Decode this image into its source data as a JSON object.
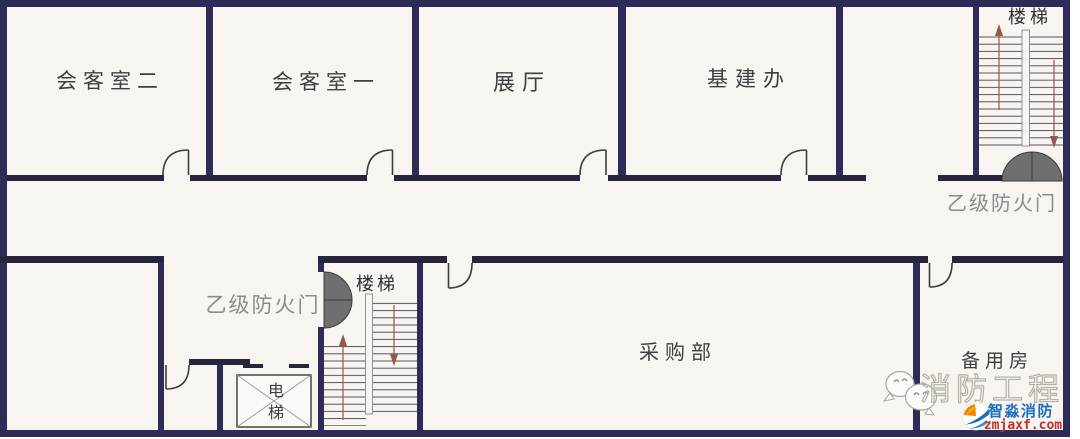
{
  "rooms": {
    "reception_2": "会客室二",
    "reception_1": "会客室一",
    "exhibition_hall": "展厅",
    "infrastructure_office": "基建办",
    "purchasing_dept": "采购部",
    "spare_room": "备用房"
  },
  "stairs": {
    "top_label": "楼梯",
    "bottom_label": "楼梯"
  },
  "fire_doors": {
    "top_right_label": "乙级防火门",
    "left_label": "乙级防火门"
  },
  "elevator": {
    "char_top": "电",
    "char_bottom": "梯"
  },
  "watermark": {
    "brand_outline": "消防工程"
  },
  "logo": {
    "name": "智淼消防",
    "site": "zmjaxf.com"
  },
  "colors": {
    "wall": "#2f2b58",
    "wall_dark": "#27243e",
    "background": "#f8f5f0",
    "fire_door_fill": "#6f6f6f",
    "stair_arrow": "#96584a",
    "logo_blue": "#1b6ec2",
    "logo_red": "#c03028",
    "watermark_gray": "#b5b1a9"
  }
}
